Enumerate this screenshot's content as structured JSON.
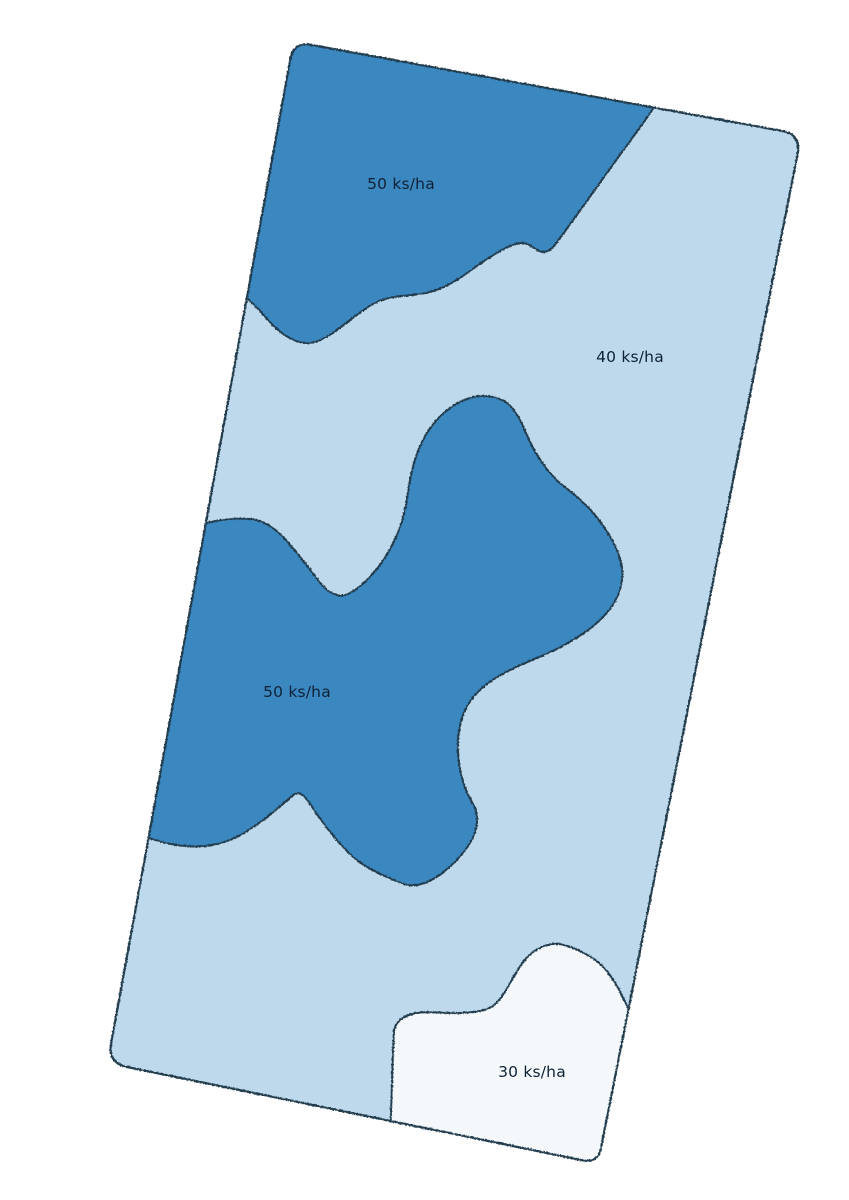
{
  "page": {
    "background_color": "#ffffff"
  },
  "map": {
    "kind": "seeding-rate-prescription-map",
    "unit": "ks/ha",
    "colors": {
      "rate_50_fill": "#3a87c0",
      "rate_40_fill": "#bfd9ec",
      "rate_30_fill": "#f4f8fb",
      "boundary_stroke": "#233c4e",
      "label_text": "#0f2236"
    },
    "zones": [
      {
        "name": "north-zone",
        "rate": 50,
        "label": "50 ks/ha"
      },
      {
        "name": "east-zone",
        "rate": 40,
        "label": "40 ks/ha"
      },
      {
        "name": "central-zone",
        "rate": 50,
        "label": "50 ks/ha"
      },
      {
        "name": "south-zone",
        "rate": 30,
        "label": "30 ks/ha"
      }
    ]
  }
}
